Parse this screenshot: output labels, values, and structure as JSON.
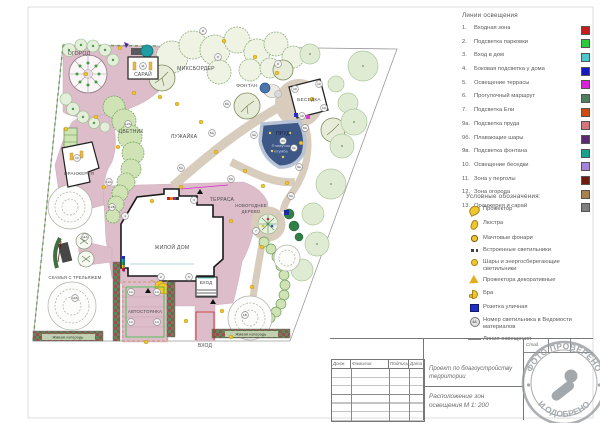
{
  "plan": {
    "area_labels": [
      {
        "text": "ОГОРОД",
        "x": 79,
        "y": 55,
        "size": 5.2
      },
      {
        "text": "САРАЙ",
        "x": 143,
        "y": 76,
        "size": 5
      },
      {
        "text": "МИКСБОРДЕР",
        "x": 196,
        "y": 70,
        "size": 5.2
      },
      {
        "text": "ЦВЕТНИК",
        "x": 131,
        "y": 133,
        "size": 5
      },
      {
        "text": "ЛУЖАЙКА",
        "x": 184,
        "y": 138,
        "size": 5.2
      },
      {
        "text": "ФОНТАН",
        "x": 247,
        "y": 87,
        "size": 4.8
      },
      {
        "text": "БЕСЕДКА",
        "x": 309,
        "y": 101,
        "size": 4.8
      },
      {
        "text": "ПРУД",
        "x": 283,
        "y": 135,
        "size": 5,
        "color": "#151f45"
      },
      {
        "text": "Плавучая",
        "x": 281,
        "y": 147,
        "size": 3.8,
        "color": "#c8d4ec"
      },
      {
        "text": "клумба",
        "x": 281,
        "y": 152.5,
        "size": 3.8,
        "color": "#c8d4ec"
      },
      {
        "text": "ОРАНЖЕРЕЯ",
        "x": 79,
        "y": 175,
        "size": 4.4
      },
      {
        "text": "ТЕРРАСА",
        "x": 222,
        "y": 201,
        "size": 5
      },
      {
        "text": "НОВОГОДНЕЕ",
        "x": 251,
        "y": 207,
        "size": 4.3
      },
      {
        "text": "ДЕРЕВО",
        "x": 251,
        "y": 213,
        "size": 4.3
      },
      {
        "text": "ЖИЛОЙ ДОМ",
        "x": 172,
        "y": 249,
        "size": 5.2
      },
      {
        "text": "ВХОД",
        "x": 206,
        "y": 284,
        "size": 4.4
      },
      {
        "text": "АВТОСТОЯНКА",
        "x": 145,
        "y": 313,
        "size": 4.4
      },
      {
        "text": "СКАМЬЯ С ТРЕЛЬЯЖЕМ",
        "x": 75,
        "y": 279,
        "size": 4.2
      },
      {
        "text": "ВХОД",
        "x": 205,
        "y": 347,
        "size": 5
      },
      {
        "text": "Живая изгородь",
        "x": 68,
        "y": 338.5,
        "size": 3.8,
        "color": "#1e2e1e"
      },
      {
        "text": "Живая изгородь",
        "x": 251,
        "y": 335.5,
        "size": 3.8,
        "color": "#1e2e1e"
      }
    ],
    "markers": [
      {
        "x": 218,
        "y": 57,
        "t": "8"
      },
      {
        "x": 278,
        "y": 64,
        "t": "8"
      },
      {
        "x": 203,
        "y": 31,
        "t": "8"
      },
      {
        "x": 143,
        "y": 66,
        "t": "11"
      },
      {
        "x": 128,
        "y": 124,
        "t": "12А"
      },
      {
        "x": 109,
        "y": 182,
        "t": "12А"
      },
      {
        "x": 112,
        "y": 207,
        "t": "12Б"
      },
      {
        "x": 77,
        "y": 158,
        "t": "13"
      },
      {
        "x": 85,
        "y": 237,
        "t": "11А"
      },
      {
        "x": 75,
        "y": 298,
        "t": "11Б"
      },
      {
        "x": 125,
        "y": 216,
        "t": "4"
      },
      {
        "x": 161,
        "y": 277,
        "t": "2"
      },
      {
        "x": 189,
        "y": 277,
        "t": "5"
      },
      {
        "x": 194,
        "y": 200,
        "t": "3"
      },
      {
        "x": 212,
        "y": 133,
        "t": "5А"
      },
      {
        "x": 181,
        "y": 168,
        "t": "5А"
      },
      {
        "x": 231,
        "y": 179,
        "t": "6А"
      },
      {
        "x": 291,
        "y": 196,
        "t": "6А"
      },
      {
        "x": 254,
        "y": 135,
        "t": "9а"
      },
      {
        "x": 299,
        "y": 167,
        "t": "9а"
      },
      {
        "x": 283,
        "y": 141,
        "t": "9б"
      },
      {
        "x": 294,
        "y": 148,
        "t": "9в"
      },
      {
        "x": 295,
        "y": 89,
        "t": "10"
      },
      {
        "x": 319,
        "y": 84,
        "t": "10"
      },
      {
        "x": 302,
        "y": 116,
        "t": "10"
      },
      {
        "x": 324,
        "y": 108,
        "t": "10"
      },
      {
        "x": 256,
        "y": 231,
        "t": "7"
      },
      {
        "x": 227,
        "y": 104,
        "t": "8А"
      },
      {
        "x": 305,
        "y": 128,
        "t": "8А"
      },
      {
        "x": 131,
        "y": 292,
        "t": "1А"
      },
      {
        "x": 157,
        "y": 292,
        "t": "1А"
      },
      {
        "x": 131,
        "y": 322,
        "t": "1А"
      },
      {
        "x": 157,
        "y": 322,
        "t": "1А"
      },
      {
        "x": 245,
        "y": 315,
        "t": "1Б"
      }
    ],
    "lights": [
      [
        120,
        48
      ],
      [
        134,
        93
      ],
      [
        160,
        97
      ],
      [
        96,
        117
      ],
      [
        118,
        147
      ],
      [
        104,
        187
      ],
      [
        66,
        129
      ],
      [
        177,
        104
      ],
      [
        201,
        122
      ],
      [
        216,
        152
      ],
      [
        245,
        171
      ],
      [
        263,
        186
      ],
      [
        287,
        183
      ],
      [
        301,
        143
      ],
      [
        312,
        99
      ],
      [
        277,
        73
      ],
      [
        255,
        57
      ],
      [
        224,
        41
      ],
      [
        181,
        187
      ],
      [
        152,
        201
      ],
      [
        231,
        221
      ],
      [
        262,
        247
      ],
      [
        252,
        287
      ],
      [
        222,
        311
      ],
      [
        146,
        342
      ],
      [
        186,
        321
      ],
      [
        231,
        337
      ],
      [
        86,
        74
      ]
    ],
    "lighting_lines": [
      {
        "color": "#cc2020",
        "points": "196,340 196,312 214,312 214,340"
      },
      {
        "color": "#2fbe3a",
        "points": "126,287 164,287 164,337 126,337 126,287"
      },
      {
        "color": "#d824d8",
        "points": "181,189 228,185"
      },
      {
        "color": "#1818c0",
        "points": "124,257 124,272"
      },
      {
        "color": "#6e1c0e",
        "points": "61,241 58,262"
      },
      {
        "color": "#4ec8c8",
        "points": "198,278 214,278"
      }
    ]
  },
  "legend_lighting": {
    "title": "Линии освещения",
    "items": [
      {
        "num": "1.",
        "label": "Входная зона",
        "color": "#c22020"
      },
      {
        "num": "2.",
        "label": "Подсветка парковки",
        "color": "#2ec83c"
      },
      {
        "num": "3.",
        "label": "Вход в дом",
        "color": "#4ec8c8"
      },
      {
        "num": "4.",
        "label": "Боковая подсветка у дома",
        "color": "#1818c0"
      },
      {
        "num": "5.",
        "label": "Освещение террасы",
        "color": "#d824d8"
      },
      {
        "num": "6.",
        "label": "Прогулочный маршрут",
        "color": "#4e7e62"
      },
      {
        "num": "7.",
        "label": "Подсветка Ели",
        "color": "#cc4c14"
      },
      {
        "num": "9а.",
        "label": "Подсветка пруда",
        "color": "#d4747e"
      },
      {
        "num": "9б.",
        "label": "Плавающие шары",
        "color": "#5c2a6e"
      },
      {
        "num": "9в.",
        "label": "Подсветка фонтана",
        "color": "#1ca08e"
      },
      {
        "num": "10.",
        "label": "Освещение беседки",
        "color": "#a684da"
      },
      {
        "num": "11.",
        "label": "Зона у перголы",
        "color": "#6e1c0e"
      },
      {
        "num": "12.",
        "label": "Зона огорода",
        "color": "#a6824e"
      },
      {
        "num": "13.",
        "label": "Оранжерея и сарай",
        "color": "#7e7e7e"
      }
    ]
  },
  "legend_symbols": {
    "title": "Условные обозначения:",
    "items": [
      {
        "icon": "floodlight",
        "label": "Прожектор"
      },
      {
        "icon": "chandelier",
        "label": "Люстра"
      },
      {
        "icon": "mast",
        "label": "Мачтовые фонари"
      },
      {
        "icon": "recessed",
        "label": "Встроенные светильники"
      },
      {
        "icon": "ball",
        "label": "Шары и энергосберегающие светильники"
      },
      {
        "icon": "deco",
        "label": "Прожектора декоративные"
      },
      {
        "icon": "sconce",
        "label": "Бра"
      },
      {
        "icon": "outlet",
        "label": "Розетка уличная"
      },
      {
        "icon": "badge",
        "label": "Номер светильника в Ведомости материалов",
        "badge": "4А"
      },
      {
        "icon": "line",
        "label": "Линия освещения"
      }
    ]
  },
  "title_block": {
    "col_headers": [
      "Долж.",
      "Фамилия",
      "Подпись",
      "Дата"
    ],
    "project_line1": "Проект по благоустройству",
    "project_line2": "территории",
    "drawing_line1": "Расположение зон",
    "drawing_line2": "освещения  М 1: 200",
    "stage_label": "Стад."
  },
  "stamp": {
    "arc_top": "ФОТО ПРОВЕРЕНО",
    "arc_bottom": "И ОДОБРЕНО"
  }
}
